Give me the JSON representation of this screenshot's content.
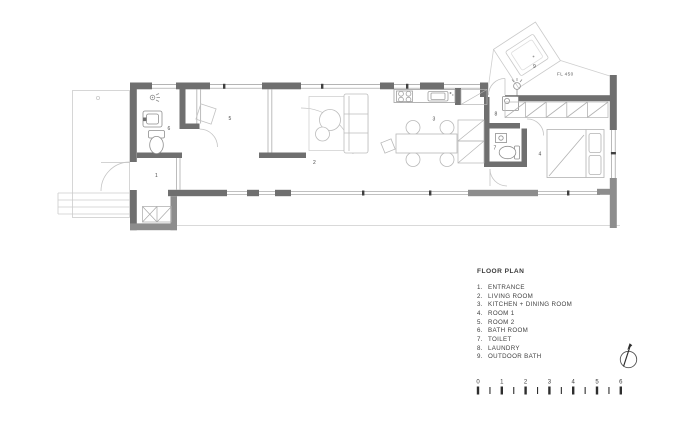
{
  "plan": {
    "fl_label": "FL 450",
    "rooms": [
      {
        "n": "1"
      },
      {
        "n": "2"
      },
      {
        "n": "3"
      },
      {
        "n": "4"
      },
      {
        "n": "5"
      },
      {
        "n": "6"
      },
      {
        "n": "7"
      },
      {
        "n": "8"
      },
      {
        "n": "9"
      }
    ]
  },
  "legend": {
    "title": "FLOOR PLAN",
    "items": [
      {
        "num": "1.",
        "label": "ENTRANCE"
      },
      {
        "num": "2.",
        "label": "LIVING ROOM"
      },
      {
        "num": "3.",
        "label": "KITCHEN + DINING ROOM"
      },
      {
        "num": "4.",
        "label": "ROOM 1"
      },
      {
        "num": "5.",
        "label": "ROOM 2"
      },
      {
        "num": "6.",
        "label": "BATH ROOM"
      },
      {
        "num": "7.",
        "label": "TOILET"
      },
      {
        "num": "8.",
        "label": "LAUNDRY"
      },
      {
        "num": "9.",
        "label": "OUTDOOR BATH"
      }
    ]
  },
  "scale_bar": {
    "labels": [
      "0",
      "1",
      "2",
      "3",
      "4",
      "5",
      "6"
    ]
  },
  "icons": {
    "north_arrow": "north-arrow"
  },
  "colors": {
    "wall_dark": "#6f6f6f",
    "wall_mid": "#8d8d8d",
    "line_light": "#c9c9c9",
    "line_fixture": "#8f8f8f",
    "text": "#3f3f3f",
    "background": "#ffffff"
  }
}
